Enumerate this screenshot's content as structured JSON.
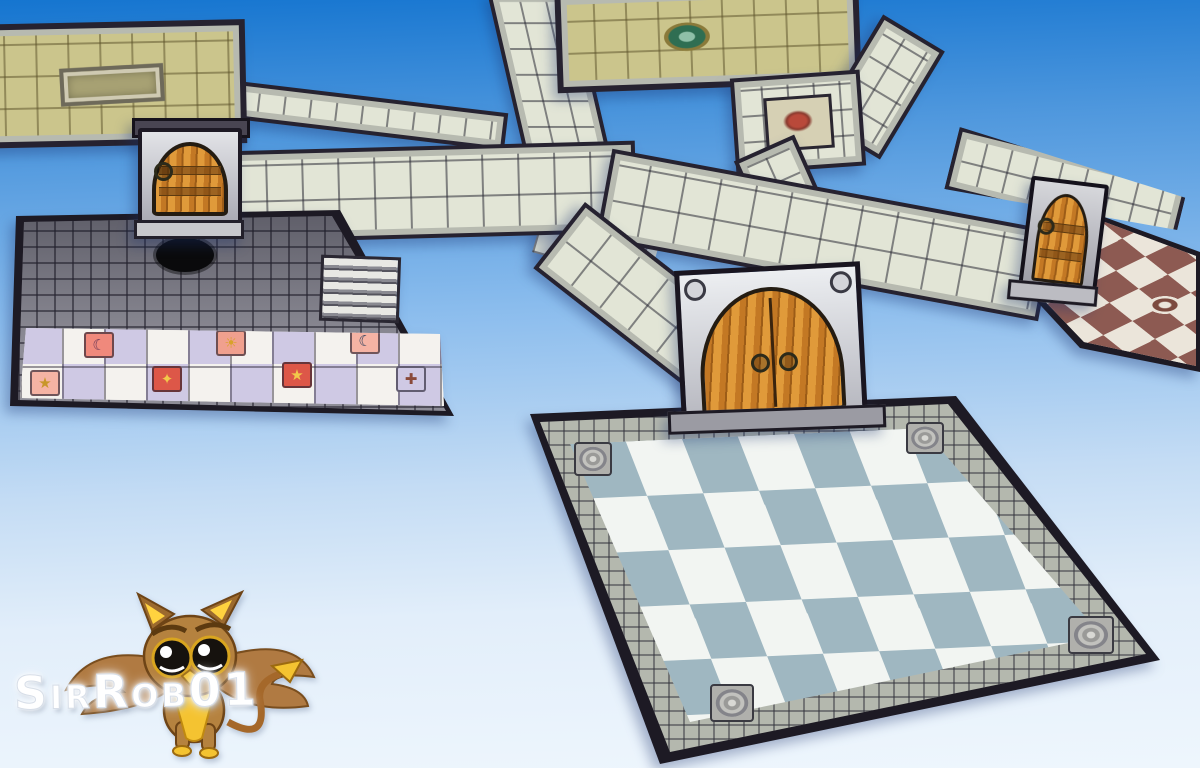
{
  "watermark": {
    "text": "SirRob01"
  },
  "scene": {
    "pieces": [
      "tan-tiled-room-with-pit",
      "narrow-corridor",
      "stone-corridor-network",
      "wooden-door",
      "dark-cobble-room-with-mosaic-floor",
      "rune-junction-tile",
      "green-circle-emblem-room",
      "great-double-door",
      "blue-checker-hall",
      "red-checker-room",
      "arched-side-door",
      "griffin-owl-mascot"
    ]
  },
  "sky": {
    "top": "#1575d0",
    "mid": "#8abced",
    "bottom": "#eef6fd"
  },
  "palette": {
    "corridor_tile": "#e2e5d6",
    "corridor_line": "rgba(45,45,55,0.55)",
    "wall_dark": "#262230",
    "stone_trim": "#b7bab0",
    "tan_tile": "#cbc58c",
    "tan_line": "rgba(90,80,40,0.5)",
    "cobble": "#8e8d97",
    "cobble_line": "rgba(40,38,50,0.6)",
    "checker_white": "#f2f5f2",
    "checker_blue": "#9fb7c1",
    "checker_red": "#8d5a52",
    "checker_cream": "#ebe5da",
    "wood": "#c37824",
    "wood_dark": "#9c5c17",
    "frame_light": "#e2e3e7",
    "frame_dark": "#a8a8b2",
    "mosaic_white": "#f4f2ee",
    "mosaic_lavender": "#cfc9e4",
    "emblem_green": "#2f6e52",
    "emblem_gold": "#8a7a3a",
    "rune_red": "#b9493a"
  },
  "big_room": {
    "checker_grid": "7x7",
    "corner_carvings": 4
  },
  "mosaic": {
    "cells": [
      {
        "glyph": "★",
        "bg": "#f5b3a4",
        "fg": "#c8962a",
        "x": 10,
        "y": 48
      },
      {
        "glyph": "☾",
        "bg": "#f0897c",
        "fg": "#6e3a58",
        "x": 64,
        "y": 10
      },
      {
        "glyph": "✦",
        "bg": "#dd5748",
        "fg": "#f2c84a",
        "x": 132,
        "y": 44
      },
      {
        "glyph": "☀",
        "bg": "#f0a08e",
        "fg": "#d8a22a",
        "x": 196,
        "y": 8
      },
      {
        "glyph": "★",
        "bg": "#dd5748",
        "fg": "#f2c84a",
        "x": 262,
        "y": 40
      },
      {
        "glyph": "☾",
        "bg": "#f5b3a4",
        "fg": "#31425e",
        "x": 330,
        "y": 6
      },
      {
        "glyph": "✚",
        "bg": "#cfc9e4",
        "fg": "#8a4a3a",
        "x": 376,
        "y": 44
      }
    ]
  }
}
